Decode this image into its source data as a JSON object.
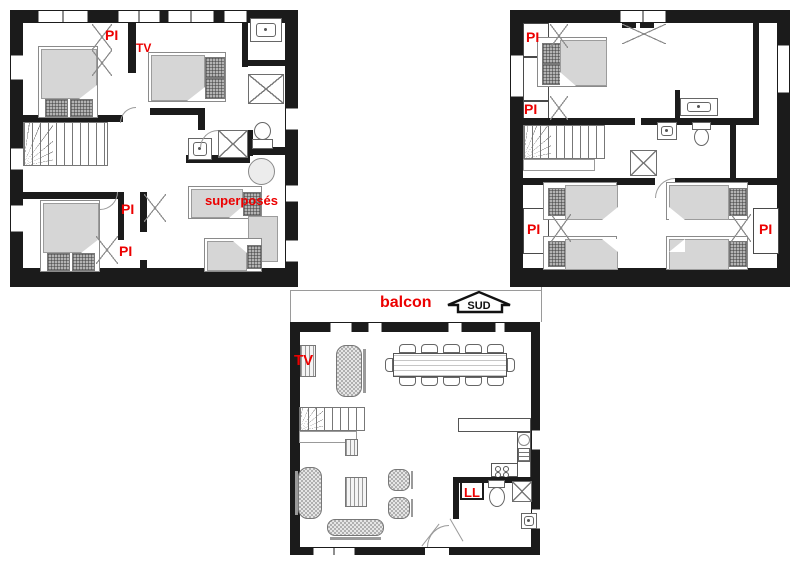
{
  "colors": {
    "wall": "#1b1b1b",
    "accent_red": "#ec0000",
    "furniture_fill": "#d6d6d6",
    "furniture_line": "#8a8a8a",
    "background": "#ffffff"
  },
  "plans": {
    "upper_left": {
      "labels": {
        "pi_top": "PI",
        "tv": "TV",
        "pi_mid": "PI",
        "pi_low": "PI",
        "bunk_beds": "superposés"
      }
    },
    "upper_right": {
      "labels": {
        "pi_1": "PI",
        "pi_2": "PI",
        "pi_3": "PI",
        "pi_4": "PI"
      }
    },
    "ground": {
      "labels": {
        "balcony": "balcon",
        "south_arrow": "SUD",
        "tv": "TV",
        "washing_machine": "LL"
      }
    }
  }
}
